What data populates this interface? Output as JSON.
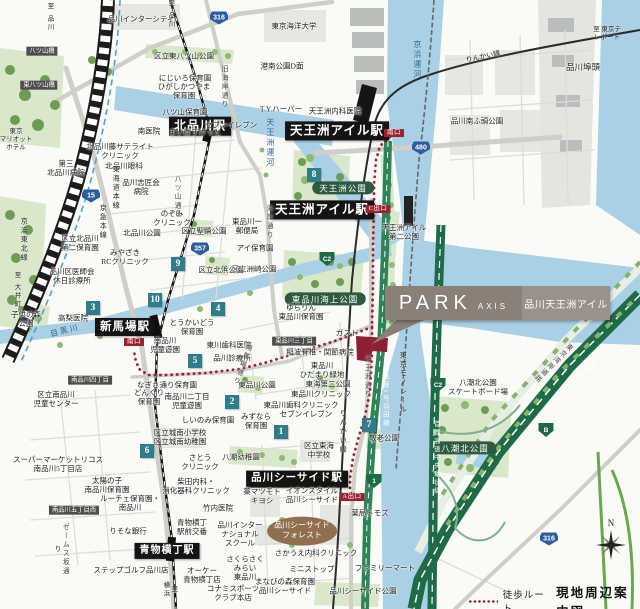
{
  "branding": {
    "logo": "PARK",
    "logo_sub": "AXIS",
    "property_name": "品川天王洲アイル"
  },
  "legend": {
    "route_label": "徒歩ルート",
    "title": "現地周辺案内図"
  },
  "compass": {
    "north_label": "N"
  },
  "colors": {
    "route_red": "#9e2130",
    "station_bg": "#141414",
    "park_pill_green": "#2e5a40",
    "badge_teal": "#2f7d8a",
    "route_shield_blue": "#2c5d9e",
    "expressway_green": "#1e6b47",
    "callout_left": "#8a8078",
    "callout_right": "#99918a",
    "forest_brown": "#8f6f4e",
    "water_blue": "#a9d0e5"
  },
  "map": {
    "labels": [
      {
        "n": "station-kitashinagawa",
        "t": "北品川駅",
        "x": 200,
        "y": 126,
        "c": "st",
        "fs": 12
      },
      {
        "n": "station-tennozu-isle-rinkai",
        "t": "天王洲アイル駅",
        "x": 337,
        "y": 131,
        "c": "st",
        "fs": 12.5
      },
      {
        "n": "station-tennozu-isle-monorail",
        "t": "天王洲アイル駅",
        "x": 322,
        "y": 210,
        "c": "st",
        "fs": 12.5
      },
      {
        "n": "station-shimbamba",
        "t": "新馬場駅",
        "x": 125,
        "y": 327,
        "c": "st",
        "fs": 11.5
      },
      {
        "n": "station-shinagawa-seaside",
        "t": "品川シーサイド駅",
        "x": 297,
        "y": 479,
        "c": "st",
        "fs": 10.5
      },
      {
        "n": "station-aomono-yokocho",
        "t": "青物横丁駅",
        "x": 167,
        "y": 551,
        "c": "st",
        "fs": 10
      },
      {
        "n": "exit-south-rinkai",
        "t": "南口",
        "x": 394,
        "y": 133,
        "c": "exit"
      },
      {
        "n": "exit-c",
        "t": "C出口",
        "x": 378,
        "y": 209,
        "c": "exit"
      },
      {
        "n": "exit-south-shimbamba",
        "t": "南口",
        "x": 134,
        "y": 342,
        "c": "exit"
      },
      {
        "n": "exit-a",
        "t": "A出口",
        "x": 352,
        "y": 497,
        "c": "exit"
      },
      {
        "n": "park-pill-tennozu",
        "t": "天王洲公園",
        "x": 343,
        "y": 188,
        "c": "pill"
      },
      {
        "n": "park-pill-kaijo",
        "t": "東品川海上公園",
        "x": 325,
        "y": 299,
        "c": "pill"
      },
      {
        "n": "park-pill-yashio-kita",
        "t": "八潮北公園",
        "x": 465,
        "y": 448,
        "c": "pill"
      },
      {
        "n": "bridge-yatsuyama",
        "t": "八ツ山橋",
        "x": 42,
        "y": 51,
        "c": "chome"
      },
      {
        "n": "bridge-higashi-yatsuyama",
        "t": "東八ツ山橋",
        "x": 39,
        "y": 85,
        "c": "chome"
      },
      {
        "n": "chome-higashishinagawa-3",
        "t": "東品川三丁目",
        "x": 294,
        "y": 341,
        "c": "chome"
      },
      {
        "n": "chome-minamishinagawa-4",
        "t": "南品川四丁目",
        "x": 90,
        "y": 380,
        "c": "chome"
      },
      {
        "n": "chome-minamishinagawa-5-west",
        "t": "南品川五丁目西",
        "x": 74,
        "y": 510,
        "c": "chome"
      },
      {
        "n": "label-seaside-forest",
        "t": "品川シーサイド\nフォレスト",
        "x": 302,
        "y": 531,
        "c": "oval"
      },
      {
        "n": "place-shinagawa-intercity",
        "t": "品川インターシティ",
        "x": 141,
        "y": 19,
        "c": "place"
      },
      {
        "n": "place-higashi-yatsuyama-park",
        "t": "区立東八ツ山公園",
        "x": 184,
        "y": 56,
        "c": "place"
      },
      {
        "n": "place-nijiiro-hoikuen",
        "t": "にじいろ保育園",
        "x": 185,
        "y": 78,
        "c": "place"
      },
      {
        "n": "place-higashikatsuyama-hoikuen",
        "t": "ひがしかつやま\n保育園",
        "x": 184,
        "y": 91,
        "c": "place"
      },
      {
        "n": "place-yatsuyama-hoikuen",
        "t": "八ツ山保育園",
        "x": 185,
        "y": 112,
        "c": "place"
      },
      {
        "n": "place-minami-iin",
        "t": "南医院",
        "x": 149,
        "y": 131,
        "c": "place"
      },
      {
        "n": "place-maibasuketto",
        "t": "まいばすけっと",
        "x": 195,
        "y": 132,
        "c": "place"
      },
      {
        "n": "place-seven-eleven-kitashinagawa",
        "t": "セブンイレブン",
        "x": 231,
        "y": 125,
        "c": "place"
      },
      {
        "n": "place-tokyo-kaiyo-univ",
        "t": "東京海洋大学",
        "x": 294,
        "y": 26,
        "c": "place"
      },
      {
        "n": "place-konan-park-d",
        "t": "港南公園D面",
        "x": 282,
        "y": 66,
        "c": "place"
      },
      {
        "n": "place-ty-harbor",
        "t": "T.Y.ハーバー",
        "x": 281,
        "y": 109,
        "c": "place"
      },
      {
        "n": "place-tennozu-naika",
        "t": "天王洲内科医院",
        "x": 335,
        "y": 111,
        "c": "place"
      },
      {
        "n": "place-shinagawa-futo",
        "t": "品川埠頭",
        "x": 583,
        "y": 67,
        "c": "place",
        "fs": 8.5
      },
      {
        "n": "place-shinagawa-minamifuto-park",
        "t": "品川南ふ頭公園",
        "x": 477,
        "y": 121,
        "c": "place"
      },
      {
        "n": "place-kitashinagawa-fuji-clinic",
        "t": "北品川藤サテライト\nクリニック",
        "x": 120,
        "y": 151,
        "c": "place"
      },
      {
        "n": "place-daisan-kitashinagawa-hosp",
        "t": "第三\n北品川病院",
        "x": 66,
        "y": 168,
        "c": "place"
      },
      {
        "n": "place-kitashinagawa-ganka",
        "t": "北品川眼科",
        "x": 124,
        "y": 166,
        "c": "place"
      },
      {
        "n": "place-shinagawa-shisyokai-hosp",
        "t": "品川志匠会\n病院",
        "x": 141,
        "y": 187,
        "c": "place"
      },
      {
        "n": "place-marriott-hotel",
        "t": "東京\nマリオット\nホテル",
        "x": 16,
        "y": 140,
        "c": "place",
        "fs": 6.5
      },
      {
        "n": "place-nozomi-clinic",
        "t": "のぞみ\nクリニック",
        "x": 172,
        "y": 218,
        "c": "place"
      },
      {
        "n": "place-kitashinagawa-park",
        "t": "北品川公園",
        "x": 142,
        "y": 233,
        "c": "place"
      },
      {
        "n": "place-miyazaki-rc-clinic",
        "t": "みやざき\nRCクリニック",
        "x": 125,
        "y": 257,
        "c": "place"
      },
      {
        "n": "place-seiseki-park",
        "t": "区立聖蹟公園",
        "x": 204,
        "y": 231,
        "c": "place"
      },
      {
        "n": "place-higashishinagawa-1-post",
        "t": "東品川一\n郵便局",
        "x": 247,
        "y": 226,
        "c": "place"
      },
      {
        "n": "place-ai-hoikuen",
        "t": "アイ保育園",
        "x": 255,
        "y": 248,
        "c": "place"
      },
      {
        "n": "place-suzaki-park",
        "t": "区立洲崎公園",
        "x": 254,
        "y": 269,
        "c": "place"
      },
      {
        "n": "place-kitahama-park",
        "t": "区立北浜公園",
        "x": 221,
        "y": 270,
        "c": "place"
      },
      {
        "n": "place-kitashinagawa-daini-hoikuen",
        "t": "区立北品川\n第二保育園",
        "x": 80,
        "y": 243,
        "c": "place"
      },
      {
        "n": "place-ishikai-shinryojo",
        "t": "品川区医師会\n休日診療所",
        "x": 72,
        "y": 276,
        "c": "place"
      },
      {
        "n": "place-kodomonomori-park",
        "t": "子供の森\n公園",
        "x": 26,
        "y": 319,
        "c": "place"
      },
      {
        "n": "place-takanashi-iin",
        "t": "高梨医院",
        "x": 73,
        "y": 318,
        "c": "place"
      },
      {
        "n": "place-tokaido-hoikuen",
        "t": "とうかいどう\n保育園",
        "x": 192,
        "y": 327,
        "c": "place"
      },
      {
        "n": "place-minamishinagawa-jidoyuen",
        "t": "南品川\n児童遊園",
        "x": 165,
        "y": 345,
        "c": "place"
      },
      {
        "n": "place-togawa-shika",
        "t": "東川歯科医院",
        "x": 229,
        "y": 345,
        "c": "place"
      },
      {
        "n": "place-shinagawa-shinryojo",
        "t": "品川診療所",
        "x": 232,
        "y": 358,
        "c": "place"
      },
      {
        "n": "place-yurarin-hoikuen",
        "t": "ゆらりん\n東品川保育園",
        "x": 301,
        "y": 312,
        "c": "place"
      },
      {
        "n": "place-gusto",
        "t": "ガスト",
        "x": 347,
        "y": 333,
        "c": "place"
      },
      {
        "n": "place-inanami-hosp",
        "t": "稲波脊椎・関節病院",
        "x": 320,
        "y": 352,
        "c": "place"
      },
      {
        "n": "place-hidamari-ryokuchi",
        "t": "東品川\nひだまり緑地",
        "x": 322,
        "y": 370,
        "c": "place"
      },
      {
        "n": "place-higashishinagawa-park",
        "t": "東品川公園",
        "x": 257,
        "y": 385,
        "c": "place"
      },
      {
        "n": "place-tokai-daini-park",
        "t": "東海第二公園",
        "x": 328,
        "y": 384,
        "c": "place"
      },
      {
        "n": "place-higashishinagawa-clinic",
        "t": "東品川クリニック",
        "x": 321,
        "y": 394,
        "c": "place"
      },
      {
        "n": "place-higashishinagawa-shika",
        "t": "東品川歯科クリニック",
        "x": 301,
        "y": 405,
        "c": "place"
      },
      {
        "n": "place-seven-eleven-higashishinagawa",
        "t": "セブンイレブン",
        "x": 306,
        "y": 414,
        "c": "place"
      },
      {
        "n": "place-nagisadori-hoikuen",
        "t": "なぎさ通り保育園",
        "x": 167,
        "y": 385,
        "c": "place"
      },
      {
        "n": "place-donguri-hoikuen",
        "t": "どんぐり\n保育園",
        "x": 149,
        "y": 397,
        "c": "place"
      },
      {
        "n": "place-minamishinagawa-2-jidoyuen",
        "t": "南品川二丁目\n児童遊園",
        "x": 187,
        "y": 401,
        "c": "place"
      },
      {
        "n": "place-jido-center",
        "t": "区立南品川\n児童センター",
        "x": 56,
        "y": 399,
        "c": "place"
      },
      {
        "n": "place-shiinomi-hoikuen",
        "t": "しいのみ保育園",
        "x": 208,
        "y": 420,
        "c": "place"
      },
      {
        "n": "place-mizunara-hoikuen",
        "t": "みずなら\n保育園",
        "x": 256,
        "y": 421,
        "c": "place"
      },
      {
        "n": "place-jonan-elementary",
        "t": "区立城南小学校\n区立城南幼稚園",
        "x": 180,
        "y": 437,
        "c": "place"
      },
      {
        "n": "place-sato-clinic",
        "t": "さとう\nクリニック",
        "x": 200,
        "y": 462,
        "c": "place"
      },
      {
        "n": "place-yashio-yochien",
        "t": "八潮幼稚園",
        "x": 241,
        "y": 457,
        "c": "place"
      },
      {
        "n": "place-supermarket-ricos",
        "t": "スーパーマーケットリコス\n南品川5丁目店",
        "x": 58,
        "y": 464,
        "c": "place"
      },
      {
        "n": "place-taiyonoko-hoikuen",
        "t": "太陽の子\n南品川保育園",
        "x": 107,
        "y": 485,
        "c": "place"
      },
      {
        "n": "place-luce-hoikuen",
        "t": "ルーチェ保育園・\n南品川",
        "x": 130,
        "y": 503,
        "c": "place"
      },
      {
        "n": "place-risona-bank",
        "t": "りそな銀行",
        "x": 128,
        "y": 531,
        "c": "place"
      },
      {
        "n": "place-shibata-naika",
        "t": "柴田内科・\n消化器科クリニック",
        "x": 196,
        "y": 486,
        "c": "place"
      },
      {
        "n": "place-takeuchi-iin",
        "t": "竹内医院",
        "x": 218,
        "y": 508,
        "c": "place"
      },
      {
        "n": "place-ekimae-koban",
        "t": "青物横丁\n駅前交番",
        "x": 192,
        "y": 527,
        "c": "place"
      },
      {
        "n": "place-international-school",
        "t": "品川インター\nナショナル\nスクール",
        "x": 240,
        "y": 534,
        "c": "place"
      },
      {
        "n": "place-matsumotokiyoshi",
        "t": "薬マツモト\nキヨシ",
        "x": 262,
        "y": 496,
        "c": "place"
      },
      {
        "n": "place-aeon-style",
        "t": "イオンスタイル\n品川シーサイド",
        "x": 312,
        "y": 495,
        "c": "place"
      },
      {
        "n": "place-yakkyoku-tomods",
        "t": "薬局トモズ",
        "x": 370,
        "y": 513,
        "c": "place"
      },
      {
        "n": "place-step-golf",
        "t": "ステップゴルフ品川店",
        "x": 131,
        "y": 570,
        "c": "place"
      },
      {
        "n": "place-ok-aomonoyokocho",
        "t": "オーケー\n青物横丁店",
        "x": 202,
        "y": 575,
        "c": "place"
      },
      {
        "n": "place-konami-sports",
        "t": "コナミスポーツ\nクラブ本店",
        "x": 233,
        "y": 593,
        "c": "place"
      },
      {
        "n": "place-manabinomori-hoikuen",
        "t": "まなびの森保育園\n品川シーサイド",
        "x": 285,
        "y": 586,
        "c": "place"
      },
      {
        "n": "place-sakurasaku-mirai",
        "t": "さくらさく\nみらい\n東品川",
        "x": 245,
        "y": 568,
        "c": "place"
      },
      {
        "n": "place-sakaue-naika",
        "t": "さかうえ内科クリニック",
        "x": 316,
        "y": 553,
        "c": "place"
      },
      {
        "n": "place-ministop",
        "t": "ミニストップ",
        "x": 312,
        "y": 569,
        "c": "place"
      },
      {
        "n": "place-familymart",
        "t": "ファミリーマート",
        "x": 385,
        "y": 568,
        "c": "place"
      },
      {
        "n": "place-seaside-park",
        "t": "品川シーサイド公園",
        "x": 363,
        "y": 591,
        "c": "place"
      },
      {
        "n": "place-tokai-junior-high",
        "t": "区立東海\n中学校",
        "x": 319,
        "y": 450,
        "c": "place"
      },
      {
        "n": "place-keiro-park",
        "t": "敬老公園",
        "x": 384,
        "y": 438,
        "c": "place"
      },
      {
        "n": "place-yashio-skateboard",
        "t": "八潮北公園\nスケートボード場",
        "x": 478,
        "y": 387,
        "c": "place"
      },
      {
        "n": "place-tennozu-isle-daini-park",
        "t": "天王洲アイル\n第二公園",
        "x": 404,
        "y": 232,
        "c": "place"
      },
      {
        "n": "water-keihin-canal",
        "t": "京浜運河",
        "x": 417,
        "y": 60,
        "c": "water v"
      },
      {
        "n": "water-tennozu-canal",
        "t": "天王洲運河",
        "x": 270,
        "y": 143,
        "c": "water v"
      },
      {
        "n": "water-meguro-river",
        "t": "目黒川",
        "x": 65,
        "y": 331,
        "c": "water",
        "r": -14
      },
      {
        "n": "rail-rinkai-line-top",
        "t": "りんかい線",
        "x": 483,
        "y": 57,
        "c": "rail",
        "r": -12
      },
      {
        "n": "rail-rinkai-line-bottom",
        "t": "りんかい線",
        "x": 343,
        "y": 432,
        "c": "rail v"
      },
      {
        "n": "rail-tokyo-monorail",
        "t": "東京モノレール",
        "x": 403,
        "y": 383,
        "c": "rail v"
      },
      {
        "n": "rail-keikyu-main-line",
        "t": "京急本線",
        "x": 103,
        "y": 222,
        "c": "rail v"
      },
      {
        "n": "rail-tokaido-main-line",
        "t": "東海道本線",
        "x": 116,
        "y": 188,
        "c": "rail v"
      },
      {
        "n": "rail-keihin-tohoku-line",
        "t": "京浜東北線",
        "x": 24,
        "y": 240,
        "c": "rail v"
      },
      {
        "n": "dir-to-shinagawa-1",
        "t": "至 品川",
        "x": 49,
        "y": 17,
        "c": "dir v"
      },
      {
        "n": "dir-to-shinagawa-2",
        "t": "至 品川",
        "x": 170,
        "y": 14,
        "c": "dir v"
      },
      {
        "n": "dir-to-oimachi",
        "t": "至 大井町",
        "x": 16,
        "y": 290,
        "c": "dir v"
      },
      {
        "n": "dir-to-tokyo-teleport",
        "t": "至 東京テレポート",
        "x": 607,
        "y": 34,
        "c": "dir"
      },
      {
        "n": "dir-to-yokohama",
        "t": "至 横浜",
        "x": 169,
        "y": 590,
        "c": "dir v"
      },
      {
        "n": "road-yatsuyama-dori",
        "t": "八ツ山通り",
        "x": 176,
        "y": 197,
        "c": "road v"
      },
      {
        "n": "road-kyu-kaigan-dori",
        "t": "旧海岸通り",
        "x": 223,
        "y": 87,
        "c": "road v"
      },
      {
        "n": "road-kaigan-dori",
        "t": "海岸通り",
        "x": 268,
        "y": 222,
        "c": "road v"
      },
      {
        "n": "road-minami-bamba-dori",
        "t": "南馬場通り",
        "x": 241,
        "y": 364,
        "c": "road v",
        "r": 20
      },
      {
        "n": "road-tennozu-dori",
        "t": "天王洲通り",
        "x": 366,
        "y": 377,
        "c": "road v"
      },
      {
        "n": "road-james-zaka-dori",
        "t": "ゼームス坂通り",
        "x": 60,
        "y": 549,
        "c": "road v"
      },
      {
        "n": "hw-shuto-haneda-line",
        "t": "首都高速1号羽田線",
        "x": 385,
        "y": 392,
        "c": "hwv v"
      },
      {
        "n": "hw-shuto-chuo-kanjo",
        "t": "首都高速中央環状線",
        "x": 436,
        "y": 458,
        "c": "hwv v"
      },
      {
        "n": "hw-shuto-wangan-line",
        "t": "首都高速湾岸線",
        "x": 573,
        "y": 381,
        "c": "hwv v",
        "r": 45
      },
      {
        "n": "road-tokyo-wangan-road",
        "t": "東京湾岸道路",
        "x": 552,
        "y": 362,
        "c": "road v",
        "r": 45
      }
    ],
    "badges": [
      {
        "n": "1",
        "x": 281,
        "y": 432
      },
      {
        "n": "2",
        "x": 232,
        "y": 402
      },
      {
        "n": "3",
        "x": 93,
        "y": 308
      },
      {
        "n": "4",
        "x": 218,
        "y": 309
      },
      {
        "n": "5",
        "x": 195,
        "y": 361
      },
      {
        "n": "6",
        "x": 147,
        "y": 451
      },
      {
        "n": "7",
        "x": 369,
        "y": 425
      },
      {
        "n": "8",
        "x": 314,
        "y": 175
      },
      {
        "n": "9",
        "x": 178,
        "y": 264
      },
      {
        "n": "10",
        "x": 155,
        "y": 300
      }
    ],
    "shields": [
      {
        "t": "316",
        "x": 219,
        "y": 18,
        "k": "blue"
      },
      {
        "t": "15",
        "x": 91,
        "y": 196,
        "k": "blue"
      },
      {
        "t": "357",
        "x": 200,
        "y": 249,
        "k": "blue"
      },
      {
        "t": "480",
        "x": 421,
        "y": 148,
        "k": "blue"
      },
      {
        "t": "316",
        "x": 549,
        "y": 539,
        "k": "blue"
      },
      {
        "t": "B",
        "x": 546,
        "y": 430,
        "k": "green"
      },
      {
        "t": "1",
        "x": 374,
        "y": 481,
        "k": "green"
      },
      {
        "t": "C2",
        "x": 327,
        "y": 259,
        "k": "green"
      },
      {
        "t": "C2",
        "x": 438,
        "y": 385,
        "k": "green"
      }
    ]
  }
}
